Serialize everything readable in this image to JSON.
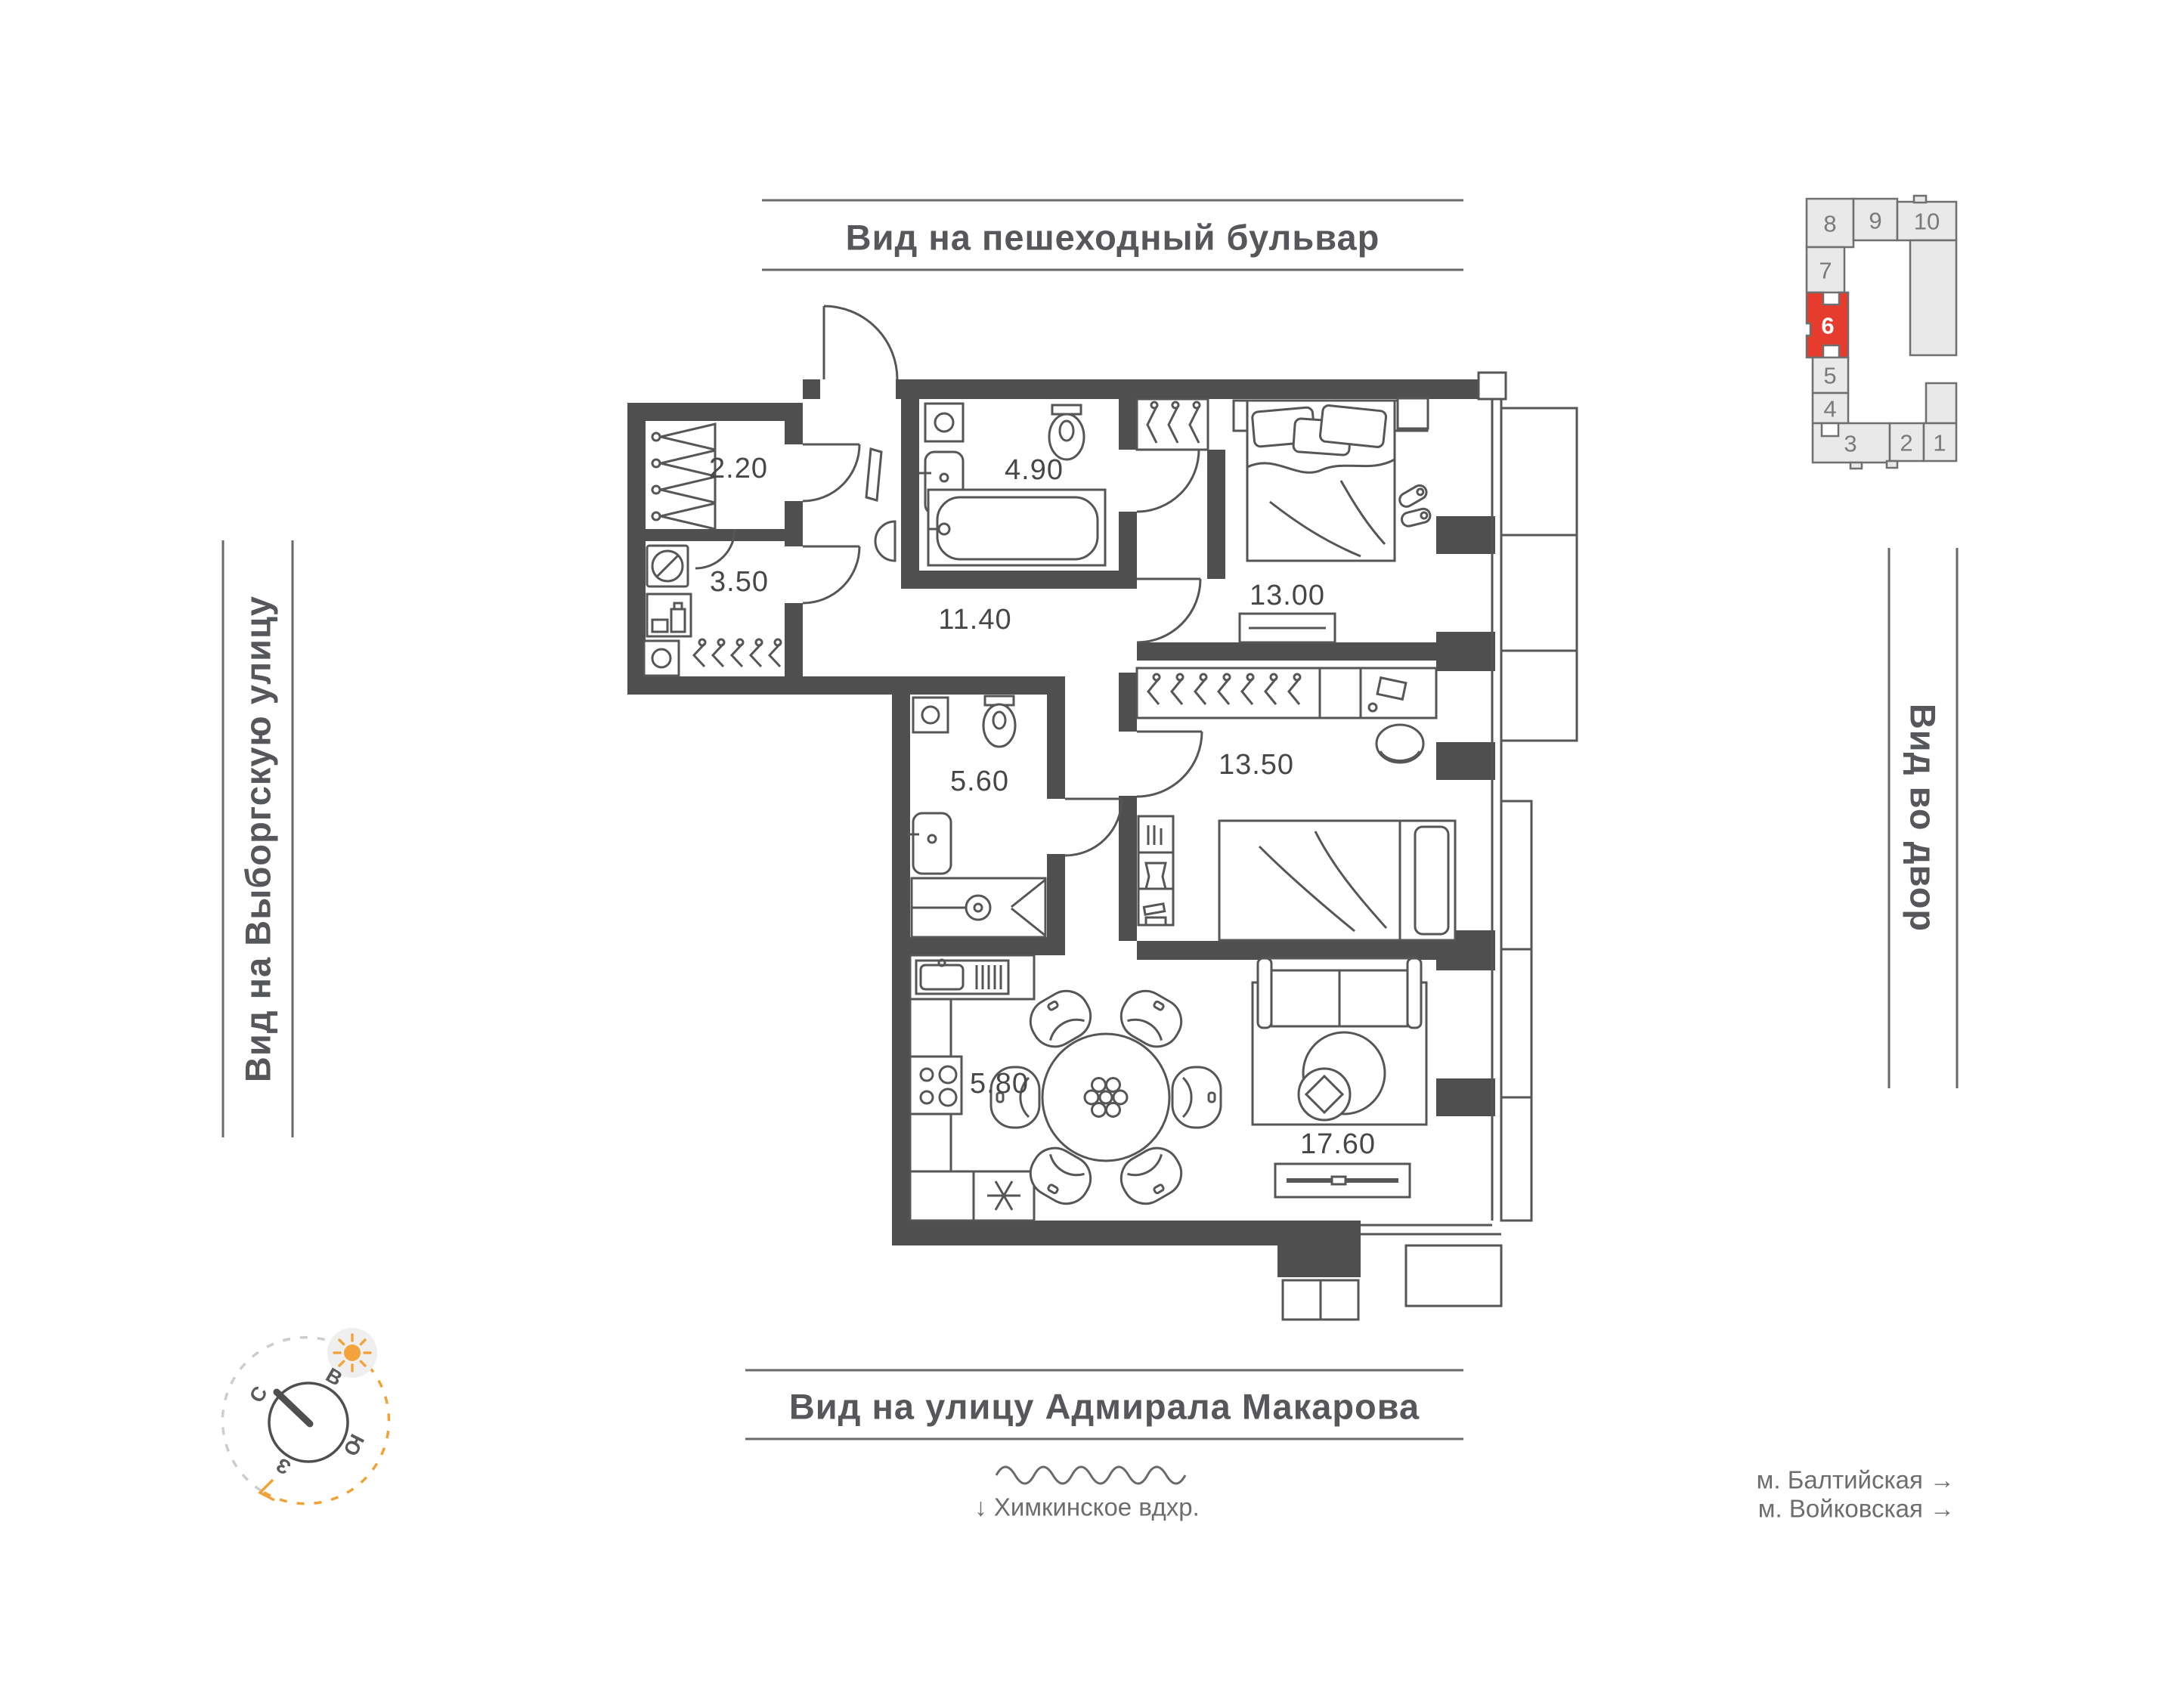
{
  "titles": {
    "top": "Вид на пешеходный бульвар",
    "bottom": "Вид на улицу Адмирала Макарова",
    "left": "Вид на Выборгскую улицу",
    "right": "Вид во двор"
  },
  "rooms": {
    "wardrobe": "2.20",
    "storage": "3.50",
    "bathroom": "4.90",
    "hallway": "11.40",
    "bedroom_1": "13.00",
    "wc": "5.60",
    "bedroom_2": "13.50",
    "kitchen": "5.80",
    "living_room": "17.60"
  },
  "landmarks": {
    "reservoir": "↓  Химкинское вдхр.",
    "metro_1": "м. Балтийская →",
    "metro_2": "м. Войковская →"
  },
  "building_plan": {
    "units": [
      "8",
      "9",
      "10",
      "7",
      "6",
      "5",
      "4",
      "3",
      "2",
      "1"
    ],
    "highlighted_unit": "6"
  },
  "compass": {
    "north": "С",
    "east": "В",
    "south": "Ю",
    "west": "З"
  },
  "colors": {
    "wall": "#4f4f4f",
    "accent_red": "#e63c2e",
    "accent_orange": "#f0a236",
    "dash_gray": "#cdcdcd",
    "schematic_fill": "#e9e9e9",
    "schematic_stroke": "#6f6f6f",
    "text_primary": "#56575a",
    "text_secondary": "#6d6d6d"
  }
}
